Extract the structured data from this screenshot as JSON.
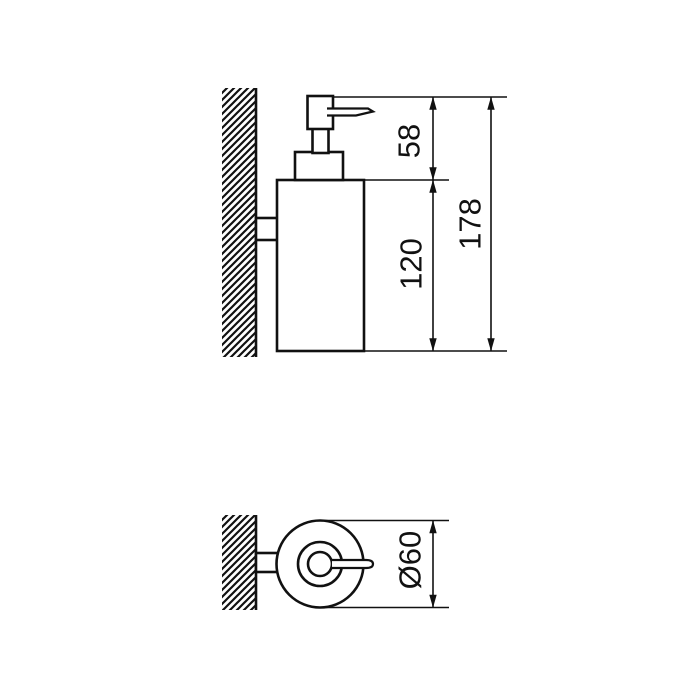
{
  "canvas": {
    "background": "#ffffff",
    "line_color": "#111111"
  },
  "side_view": {
    "dim_pump_height": "58",
    "dim_body_height": "120",
    "dim_overall_height": "178"
  },
  "plan_view": {
    "dim_diameter": "Ø60"
  }
}
